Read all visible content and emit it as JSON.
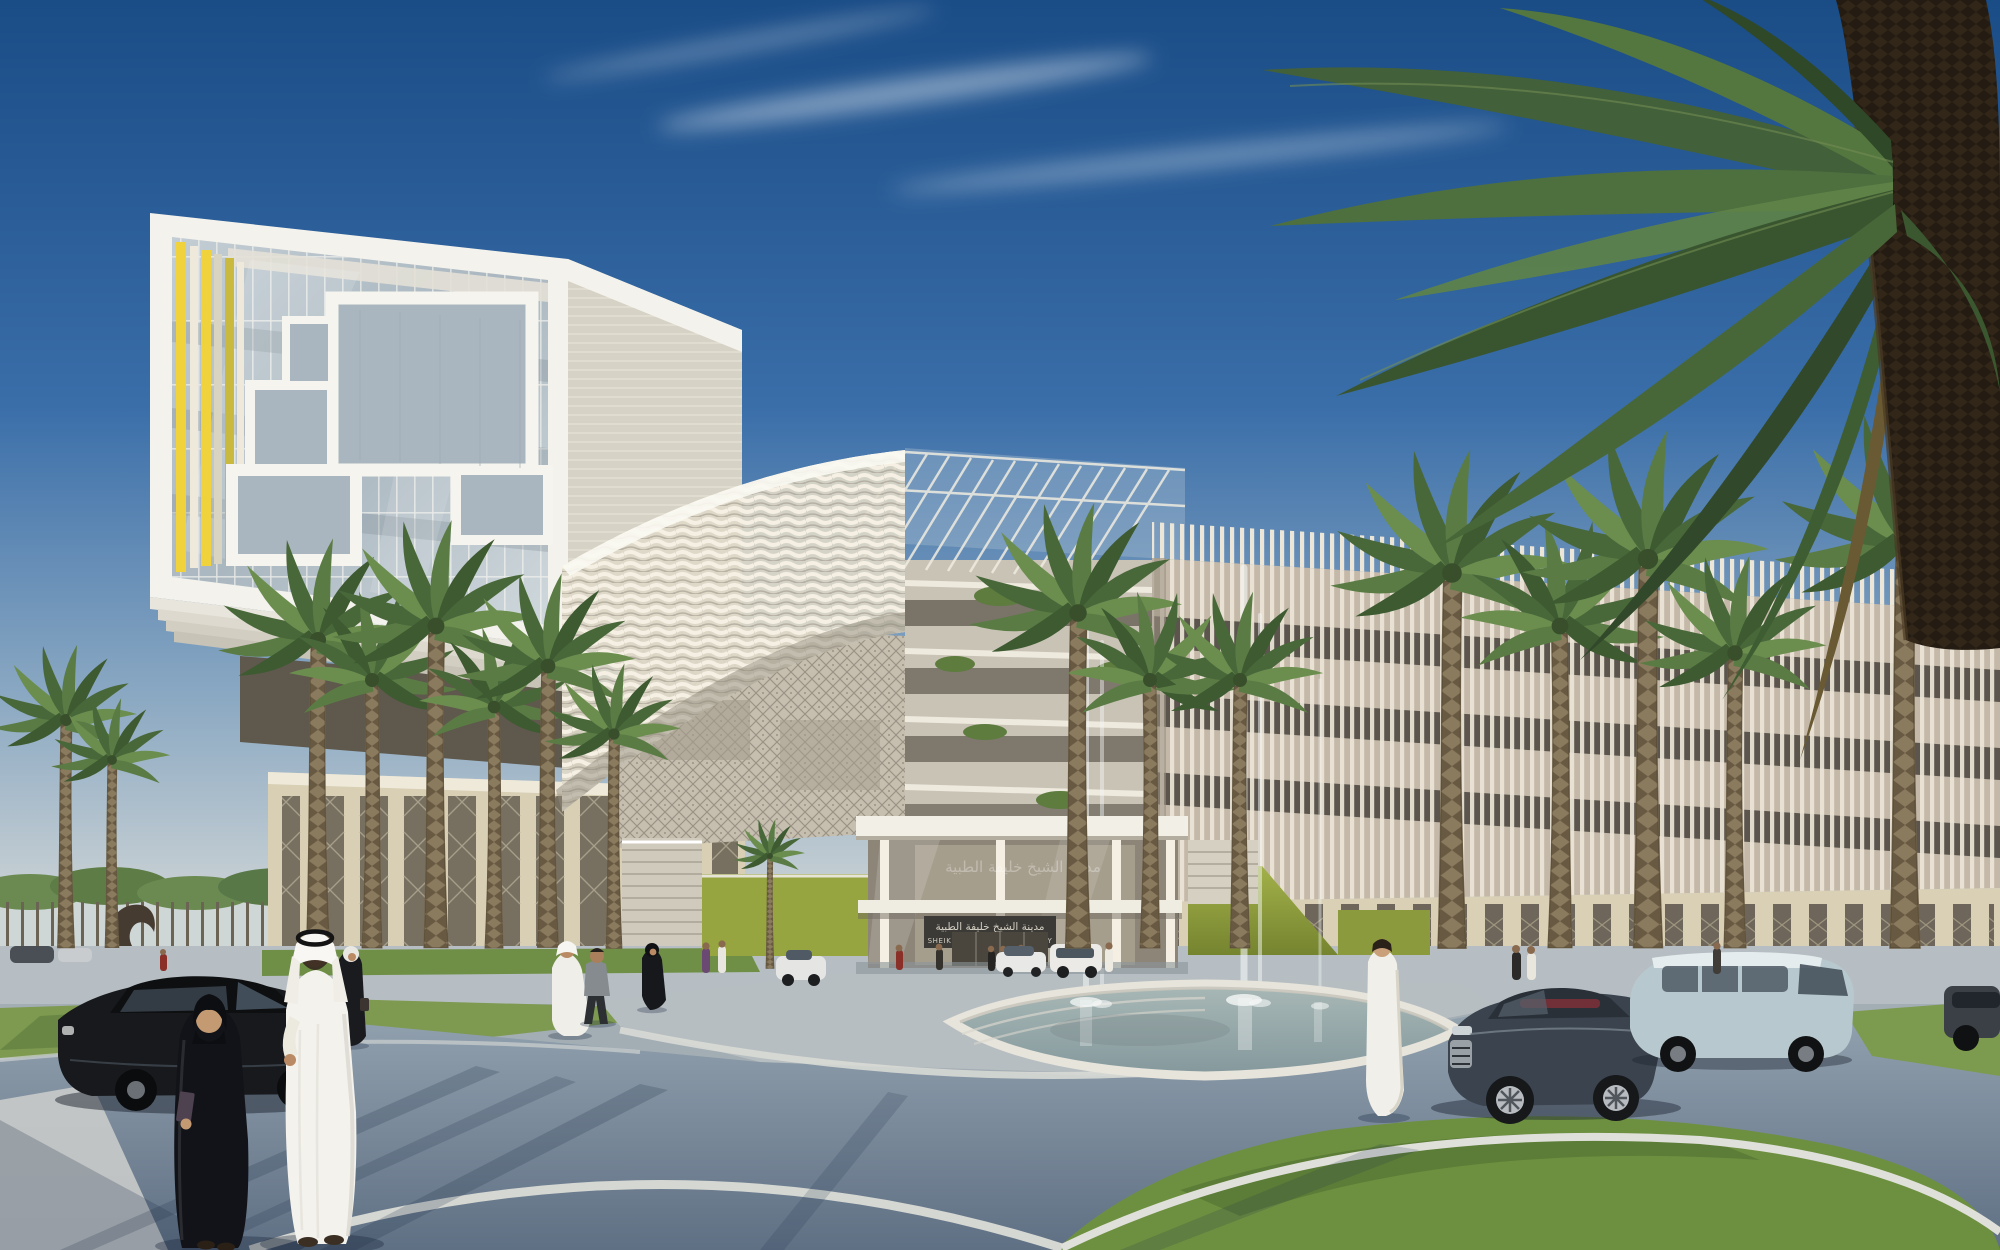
{
  "meta": {
    "kind": "architectural-rendering",
    "dimensions": "2000x1250",
    "title": "Sheikh Khalifa Medical City — entrance plaza rendering"
  },
  "scene": {
    "time_of_day": "day",
    "sky": "clear deep blue sky with thin wispy cloud streaks",
    "description": "Contemporary white medical campus: cantilevered glass block with yellow fins on the left, wavy louvered canopy over a glass entrance pavilion, vertical-fin slab building on the right, fountain pool with tall water jets, palm-lined roads and plazas, figures in Emirati dress, cars on the ring road, a large foreground date palm at the right edge"
  },
  "signage": {
    "arabic": "مدينة الشيخ خليفة الطبية",
    "english": "SHEIKH KHALIFA MEDICAL CITY"
  },
  "palette": {
    "sky_top": "#1a4c86",
    "sky_mid": "#3a6ea9",
    "sky_horizon": "#c9d1d4",
    "building_white": "#f4f2ec",
    "accent_yellow": "#f0d23c",
    "stone_beige": "#d8cfb4",
    "glass_blue": "#b6c2cb",
    "louver_cream": "#e7e0cf",
    "fin_white": "#ece6d8",
    "grass_green": "#7d9a50",
    "grass_dark": "#6d9040",
    "olive_wall": "#96a53f",
    "road_asphalt": "#8494a3",
    "road_light": "#b7bec1",
    "pool_water": "#a8b8b6",
    "palm_green": "#55763f",
    "palm_trunk": "#6e6148",
    "sign_bg": "#3b3a36",
    "sign_text": "#d3cec2",
    "car_black": "#17191c",
    "car_audi_gray": "#3a434e",
    "van_blue": "#b7c9ce",
    "skin": "#c49a72"
  },
  "inventory": {
    "buildings": [
      {
        "name": "left-tower",
        "style": "cantilevered white box, glass curtain wall, Mondrian window frames, yellow vertical fins, sandstone mashrabiya podium"
      },
      {
        "name": "entrance-canopy",
        "style": "curved wavy louvered shell with glass trellis"
      },
      {
        "name": "entrance-pavilion",
        "style": "glass lobby box with signage band"
      },
      {
        "name": "right-slab",
        "style": "dense vertical white fins over dark window bands, sandstone podium"
      },
      {
        "name": "terraced-wing",
        "style": "stepped floors with planted edges"
      }
    ],
    "vehicles": [
      {
        "name": "black-sedan",
        "position": "foreground left"
      },
      {
        "name": "dark-gray-coupe",
        "position": "right road, red interior"
      },
      {
        "name": "light-blue-van",
        "position": "right background"
      },
      {
        "name": "white-sedan",
        "position": "entrance drop-off"
      },
      {
        "name": "white-suv",
        "position": "entrance drop-off"
      },
      {
        "name": "white-car",
        "position": "center-left road"
      },
      {
        "name": "dark-car-partial",
        "position": "far right edge"
      }
    ],
    "people": [
      {
        "name": "emirati-couple",
        "detail": "man in white kandura and ghutra, woman in black abaya holding a book, foreground left"
      },
      {
        "name": "walkers-center",
        "detail": "man in kandura, man in gray shirt, woman in abaya"
      },
      {
        "name": "woman-white-hijab",
        "detail": "walking left of center"
      },
      {
        "name": "white-robed-walker",
        "detail": "back view near fountain"
      },
      {
        "name": "small-figures",
        "detail": "near entrance and right podium"
      }
    ],
    "vegetation": [
      "background palm grove",
      "palm rows at both podiums",
      "large foreground date palm"
    ],
    "water_features": [
      "reflecting pool with stepped rim",
      "tall fountain jets with splash"
    ]
  }
}
